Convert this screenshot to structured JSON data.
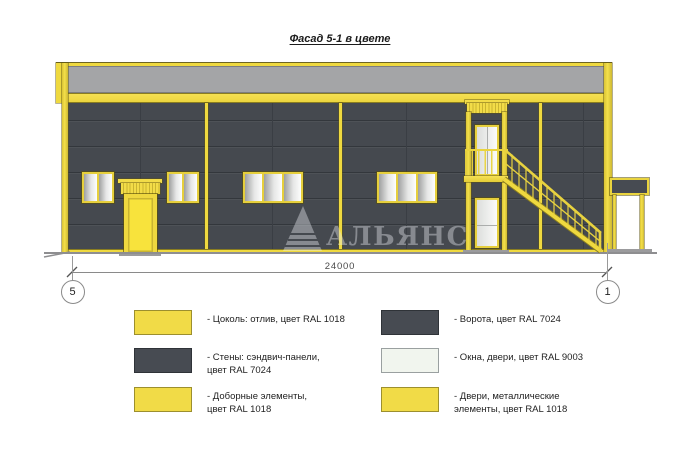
{
  "title": "Фасад 5-1 в цвете",
  "watermark": {
    "text": "АЛЬЯНС"
  },
  "dimension": {
    "length_label": "24000"
  },
  "axes": {
    "left": "5",
    "right": "1"
  },
  "legend": {
    "items": [
      {
        "text": "- Цоколь: отлив, цвет RAL 1018",
        "swatch": "ral1018"
      },
      {
        "text": "- Стены: сэндвич-панели,\nцвет RAL 7024",
        "swatch": "ral7024"
      },
      {
        "text": "- Доборные элементы,\nцвет RAL 1018",
        "swatch": "ral1018"
      },
      {
        "text": "- Ворота, цвет RAL 7024",
        "swatch": "ral7024"
      },
      {
        "text": "- Окна, двери, цвет RAL 9003",
        "swatch": "ral9003"
      },
      {
        "text": "- Двери, металлические\nэлементы, цвет RAL 1018",
        "swatch": "ral1018"
      }
    ]
  },
  "colors": {
    "ral1018": "#F1DB47",
    "ral7024": "#474B52",
    "ral9003": "#F1F5EE",
    "wall": "#45494F",
    "parapet": "#A4A5A7",
    "accent_yellow": "#EFD93F"
  }
}
